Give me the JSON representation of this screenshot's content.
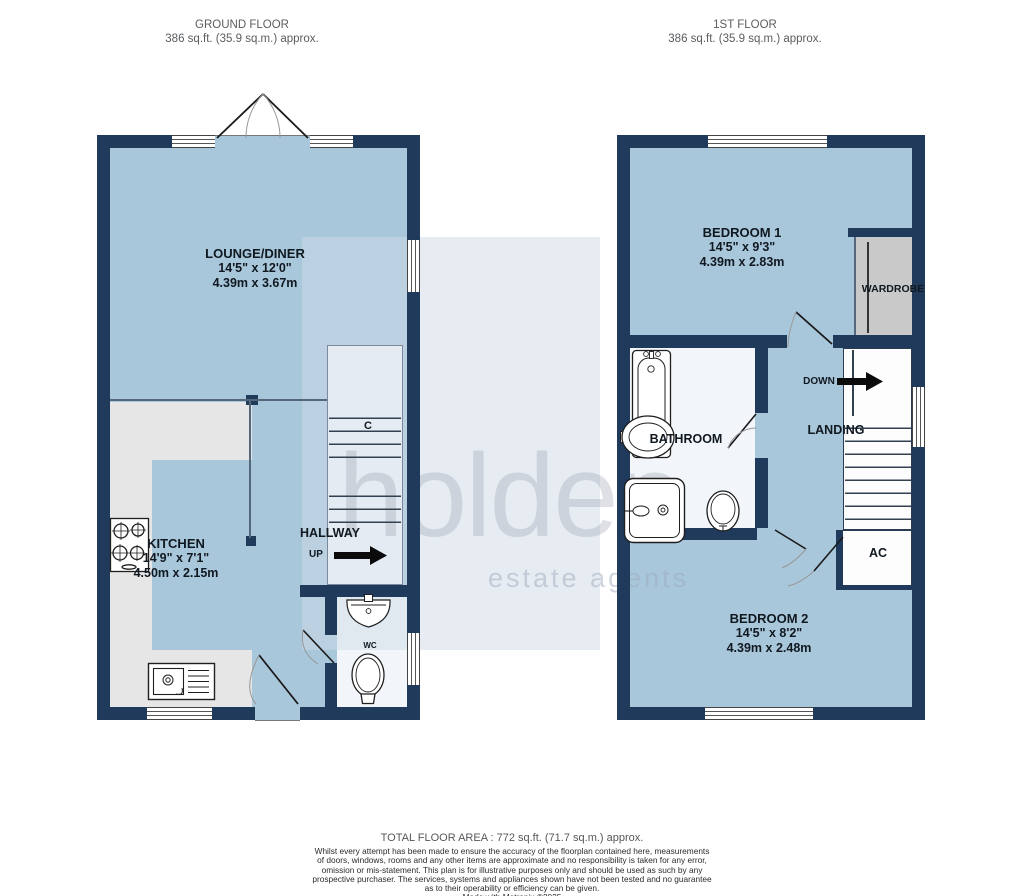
{
  "colors": {
    "wall": "#203a5c",
    "floor_blue": "#a9c7db",
    "pale_floor": "#f2f6fa",
    "counter_gray": "#e6e6e6",
    "wardrobe_gray": "#c9c9c9"
  },
  "titles": {
    "ground": {
      "title": "GROUND FLOOR",
      "area": "386 sq.ft. (35.9 sq.m.) approx."
    },
    "first": {
      "title": "1ST FLOOR",
      "area": "386 sq.ft. (35.9 sq.m.) approx."
    }
  },
  "rooms": {
    "lounge": {
      "name": "LOUNGE/DINER",
      "imperial": "14'5\"  x 12'0\"",
      "metric": "4.39m  x 3.67m"
    },
    "kitchen": {
      "name": "KITCHEN",
      "imperial": "14'9\"  x 7'1\"",
      "metric": "4.50m  x 2.15m"
    },
    "bedroom1": {
      "name": "BEDROOM 1",
      "imperial": "14'5\"  x 9'3\"",
      "metric": "4.39m  x 2.83m"
    },
    "bedroom2": {
      "name": "BEDROOM 2",
      "imperial": "14'5\"  x 8'2\"",
      "metric": "4.39m  x 2.48m"
    }
  },
  "labels": {
    "hallway": "HALLWAY",
    "up": "UP",
    "cupboard": "C",
    "wc": "WC",
    "bathroom": "BATHROOM",
    "landing": "LANDING",
    "down": "DOWN",
    "wardrobe": "WARDROBE",
    "ac": "AC"
  },
  "watermark": {
    "name": "holden",
    "tagline": "estate agents"
  },
  "footer": {
    "total": "TOTAL FLOOR AREA : 772 sq.ft. (71.7 sq.m.) approx.",
    "disclaimer_lines": [
      "Whilst every attempt has been made to ensure the accuracy of the floorplan contained here, measurements",
      "of doors, windows, rooms and any other items are approximate and no responsibility is taken for any error,",
      "omission or mis-statement. This plan is for illustrative purposes only and should be used as such by any",
      "prospective purchaser. The services, systems and appliances shown have not been tested and no guarantee",
      "as to their operability or efficiency can be given."
    ],
    "credit": "Made with Metropix ©2025"
  }
}
